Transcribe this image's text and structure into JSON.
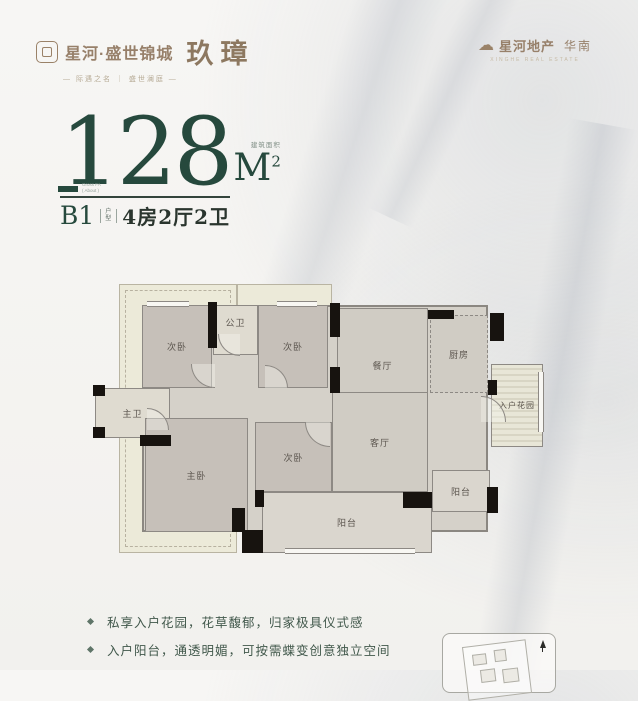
{
  "colors": {
    "accent_green": "#26493d",
    "brand_brown": "#97806a",
    "wall_black": "#17130f",
    "room_fill": "#d5d1c9",
    "bedroom_fill": "#c6c0b9",
    "envelope_cream": "#ecead9"
  },
  "header": {
    "left": {
      "brand": "星河·盛世锦城",
      "product": "玖璋",
      "tagline": "— 际遇之名 ｜ 盛世澜庭 —"
    },
    "right": {
      "brand": "星河地产",
      "region": "华南",
      "subtext": "XINGHE REAL ESTATE"
    }
  },
  "headline": {
    "area_value": "128",
    "area_label": "建筑面积",
    "area_unit": "M",
    "area_sup": "2",
    "area_note_1": "Gross FA",
    "area_note_2": "( About )",
    "unit_code": "B1",
    "unit_code_label": "户型",
    "unit_layout": "4房2厅2卫"
  },
  "floorplan": {
    "rooms": {
      "bed2": "次卧",
      "public_bath": "公卫",
      "bed3": "次卧",
      "dining": "餐厅",
      "kitchen": "厨房",
      "entry_garden": "入户花园",
      "master_bath": "主卫",
      "master": "主卧",
      "bed4": "次卧",
      "living": "客厅",
      "balcony_main": "阳台",
      "balcony_side": "阳台"
    }
  },
  "notes": {
    "items": [
      "私享入户花园，花草馥郁，归家极具仪式感",
      "入户阳台，通透明媚，可按需蝶变创意独立空间"
    ]
  }
}
